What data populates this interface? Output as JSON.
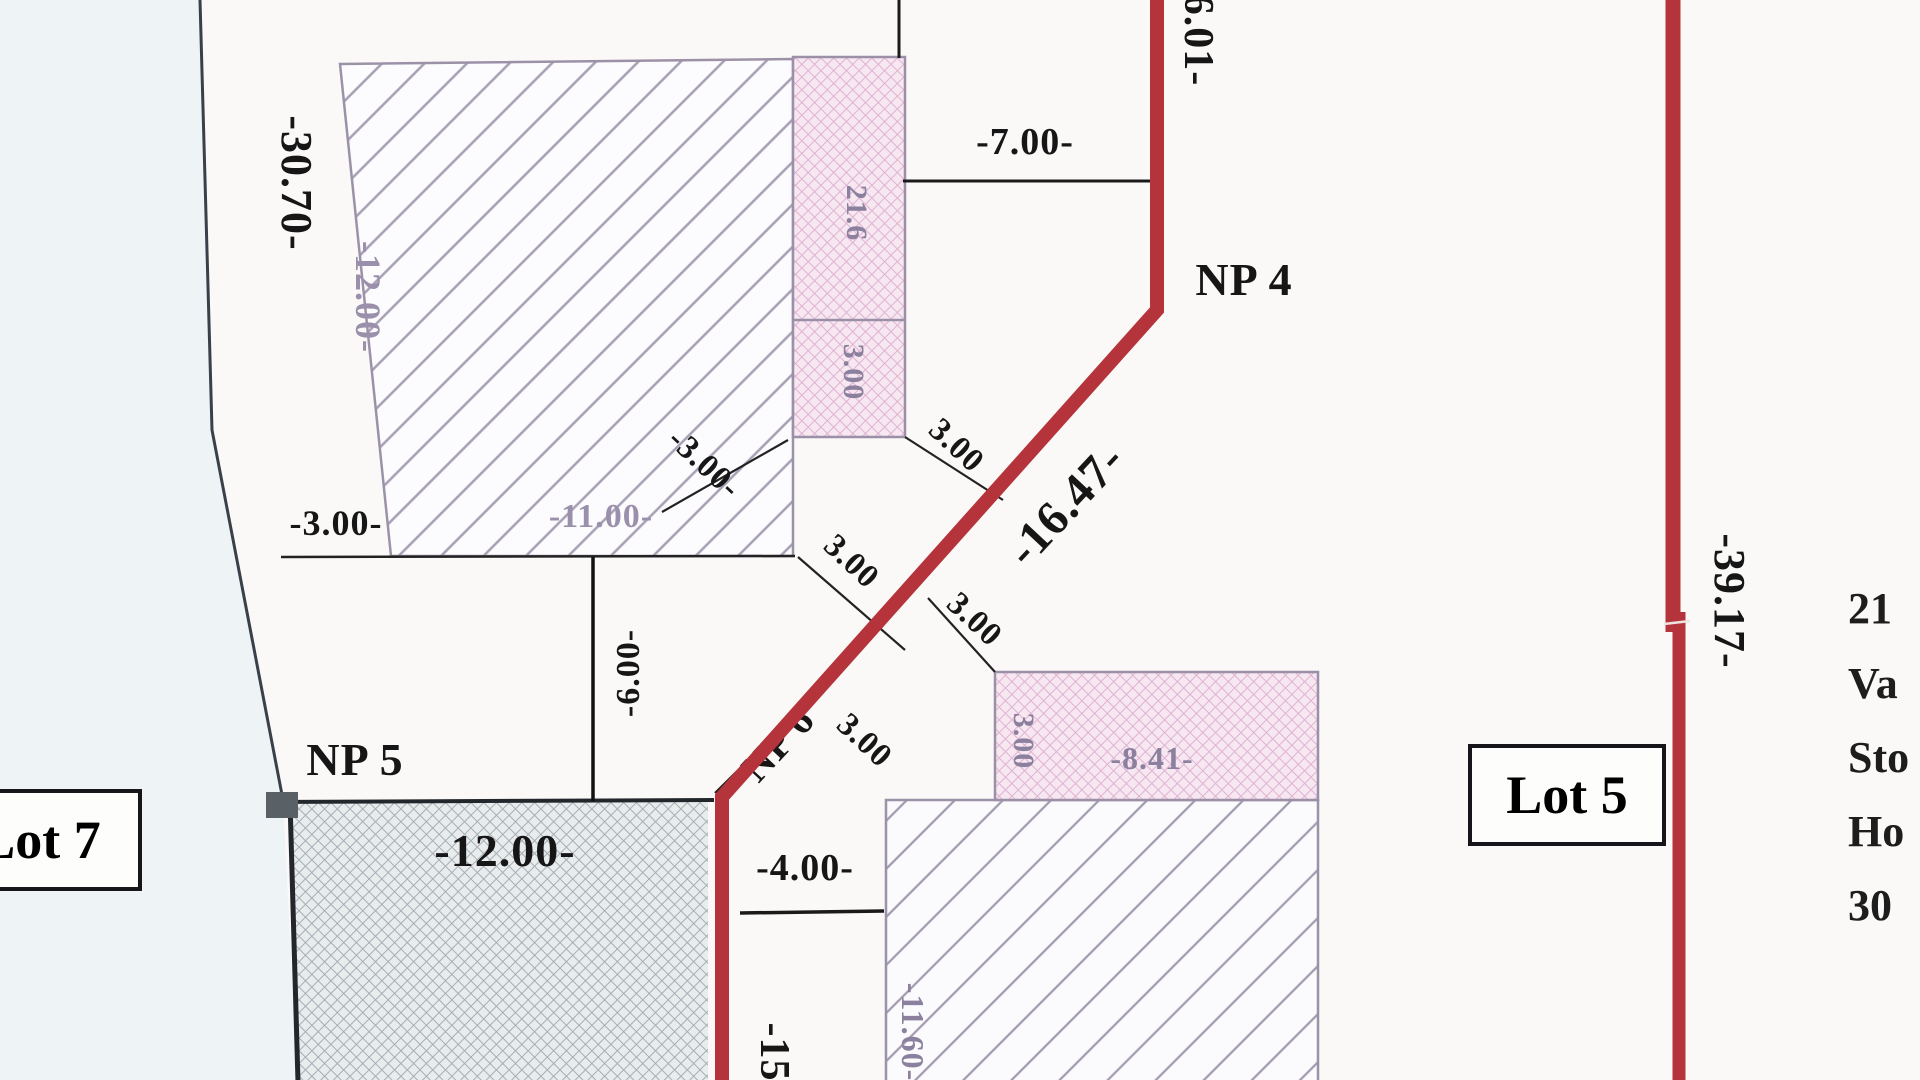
{
  "boundary": {
    "left_label": "-30.70-",
    "right_label": "-39.17-",
    "diagonal_label": "-16.47-",
    "top_right_label": "6.01-",
    "bottom_red_label": "-15",
    "red_color": "#b5343b"
  },
  "points": {
    "np4": "NP 4",
    "np5": "NP 5",
    "np6": "NP 6"
  },
  "lots": {
    "lot5": "Lot 5",
    "lot7": "Lot 7"
  },
  "dims": {
    "top_offset": "-7.00-",
    "left_gap": "-3.00-",
    "building_width_11": "-11.00-",
    "building_depth_12": "-12.00-",
    "room_height_6": "-6.00-",
    "gray_building_12": "-12.00-",
    "lower_gap_4": "-4.00-",
    "strip_width_8_41": "-8.41-",
    "lot5_building_depth": "-11.60-"
  },
  "ticks": {
    "a": "3.00",
    "b": "3.00",
    "c": "3.00",
    "d": "-3.00-",
    "e": "3.00"
  },
  "strip_labels": {
    "upper": "21.6",
    "lower": "3.00",
    "lot5_strip": "3.00"
  },
  "address_block": {
    "lines": [
      "21",
      "Va",
      "Sto",
      "Ho",
      "30"
    ]
  }
}
